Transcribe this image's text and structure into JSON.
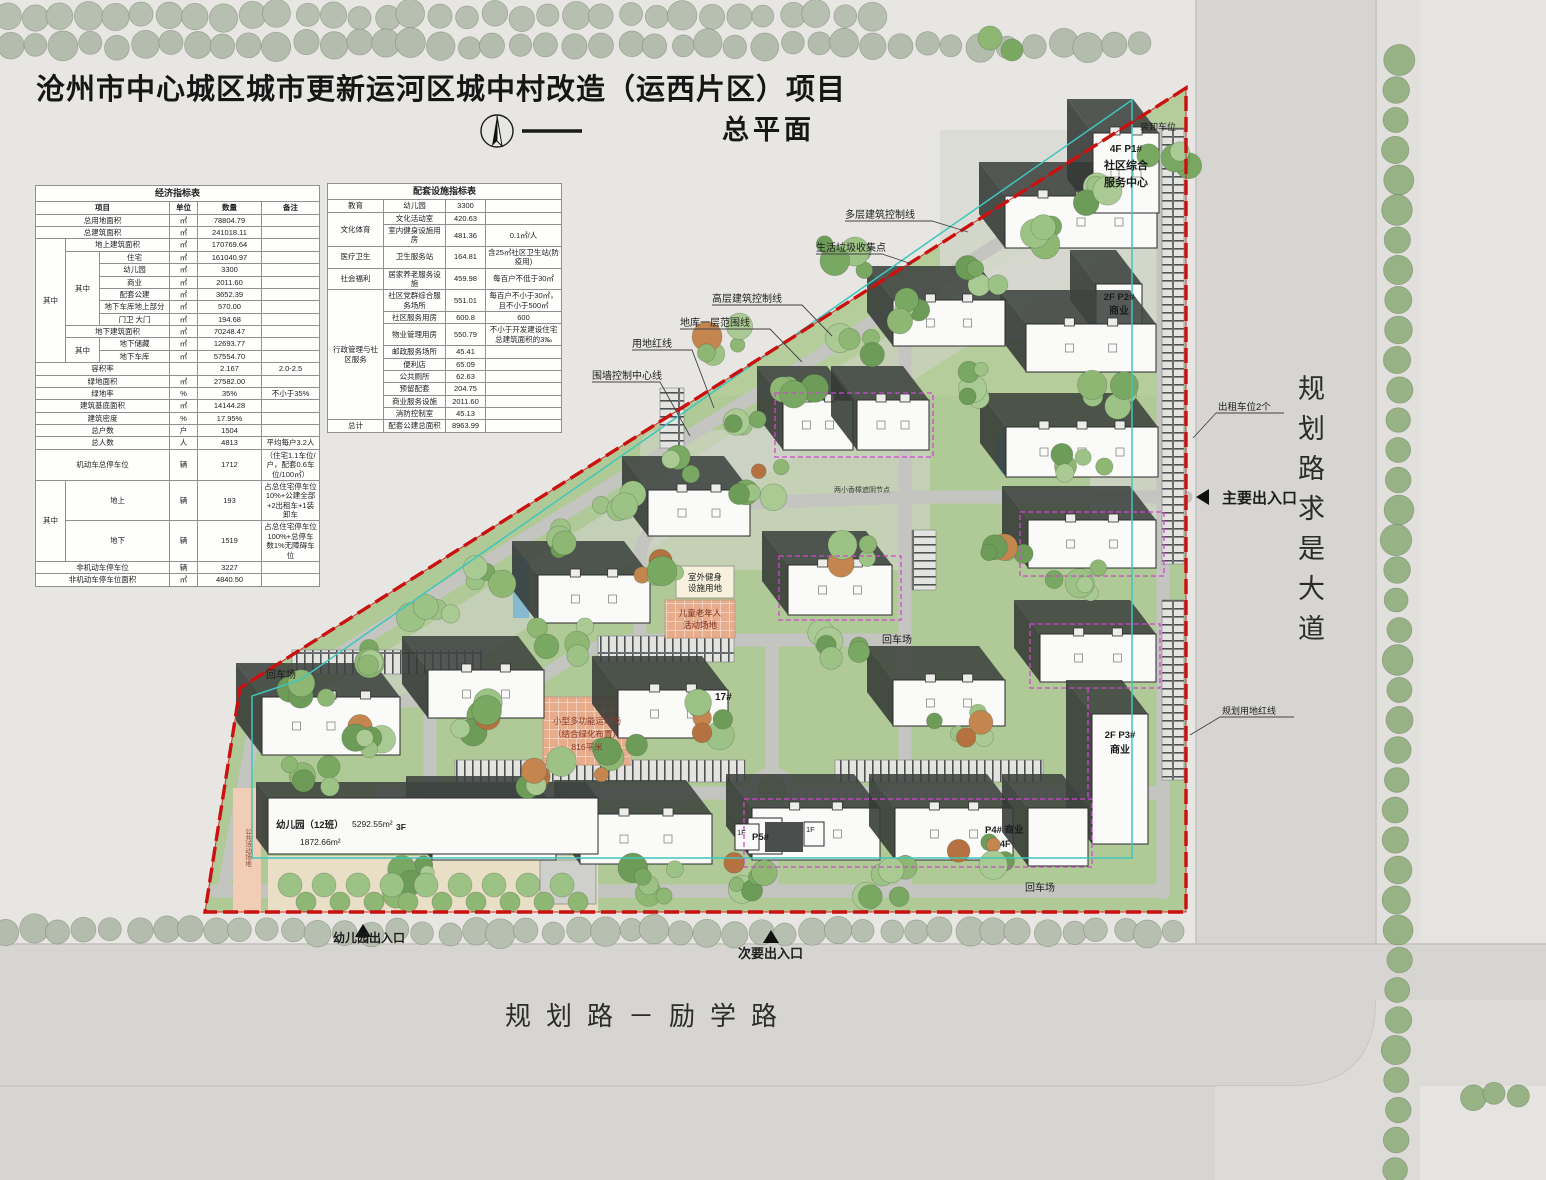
{
  "title": "沧州市中心城区城市更新运河区城中村改造（运西片区）项目",
  "subtitle": "总平面",
  "roads": {
    "east": "规划路求是大道",
    "south": "规划路－励学路"
  },
  "economic_table": {
    "rows": [
      [
        {
          "t": "经济指标表",
          "cs": 6,
          "cl": "th"
        }
      ],
      [
        {
          "t": "项目",
          "cs": 3,
          "cl": "hd"
        },
        {
          "t": "单位",
          "cl": "hd"
        },
        {
          "t": "数量",
          "cl": "hd"
        },
        {
          "t": "备注",
          "cl": "hd"
        }
      ],
      [
        {
          "t": "总用地面积",
          "cs": 3
        },
        {
          "t": "㎡"
        },
        {
          "t": "78804.79"
        },
        {
          "t": ""
        }
      ],
      [
        {
          "t": "总建筑面积",
          "cs": 3
        },
        {
          "t": "㎡"
        },
        {
          "t": "241018.11"
        },
        {
          "t": ""
        }
      ],
      [
        {
          "t": "其中",
          "rs": 10
        },
        {
          "t": "地上建筑面积",
          "cs": 2
        },
        {
          "t": "㎡"
        },
        {
          "t": "170769.64"
        },
        {
          "t": ""
        }
      ],
      [
        {
          "t": "其中",
          "rs": 6
        },
        {
          "t": "住宅"
        },
        {
          "t": "㎡"
        },
        {
          "t": "161040.97"
        },
        {
          "t": ""
        }
      ],
      [
        {
          "t": "幼儿园"
        },
        {
          "t": "㎡"
        },
        {
          "t": "3300"
        },
        {
          "t": ""
        }
      ],
      [
        {
          "t": "商业"
        },
        {
          "t": "㎡"
        },
        {
          "t": "2011.60"
        },
        {
          "t": ""
        }
      ],
      [
        {
          "t": "配套公建"
        },
        {
          "t": "㎡"
        },
        {
          "t": "3652.39"
        },
        {
          "t": ""
        }
      ],
      [
        {
          "t": "地下车库地上部分"
        },
        {
          "t": "㎡"
        },
        {
          "t": "570.00"
        },
        {
          "t": ""
        }
      ],
      [
        {
          "t": "门卫 大门"
        },
        {
          "t": "㎡"
        },
        {
          "t": "194.68"
        },
        {
          "t": ""
        }
      ],
      [
        {
          "t": "地下建筑面积",
          "cs": 2
        },
        {
          "t": "㎡"
        },
        {
          "t": "70248.47"
        },
        {
          "t": ""
        }
      ],
      [
        {
          "t": "其中",
          "rs": 2
        },
        {
          "t": "地下储藏"
        },
        {
          "t": "㎡"
        },
        {
          "t": "12693.77"
        },
        {
          "t": ""
        }
      ],
      [
        {
          "t": "地下车库"
        },
        {
          "t": "㎡"
        },
        {
          "t": "57554.70"
        },
        {
          "t": ""
        }
      ],
      [
        {
          "t": "容积率",
          "cs": 3
        },
        {
          "t": ""
        },
        {
          "t": "2.167"
        },
        {
          "t": "2.0-2.5"
        }
      ],
      [
        {
          "t": "绿地面积",
          "cs": 3
        },
        {
          "t": "㎡"
        },
        {
          "t": "27582.00"
        },
        {
          "t": ""
        }
      ],
      [
        {
          "t": "绿地率",
          "cs": 3
        },
        {
          "t": "%"
        },
        {
          "t": "35%"
        },
        {
          "t": "不小于35%"
        }
      ],
      [
        {
          "t": "建筑基底面积",
          "cs": 3
        },
        {
          "t": "㎡"
        },
        {
          "t": "14144.28"
        },
        {
          "t": ""
        }
      ],
      [
        {
          "t": "建筑密度",
          "cs": 3
        },
        {
          "t": "%"
        },
        {
          "t": "17.95%"
        },
        {
          "t": ""
        }
      ],
      [
        {
          "t": "总户数",
          "cs": 3
        },
        {
          "t": "户"
        },
        {
          "t": "1504"
        },
        {
          "t": ""
        }
      ],
      [
        {
          "t": "总人数",
          "cs": 3
        },
        {
          "t": "人"
        },
        {
          "t": "4813"
        },
        {
          "t": "平均每户3.2人"
        }
      ],
      [
        {
          "t": "机动车总停车位",
          "cs": 3
        },
        {
          "t": "辆"
        },
        {
          "t": "1712"
        },
        {
          "t": "（住宅1.1车位/户，配套0.6车位/100㎡）"
        }
      ],
      [
        {
          "t": "其中",
          "rs": 2
        },
        {
          "t": "地上",
          "cs": 2
        },
        {
          "t": "辆"
        },
        {
          "t": "193"
        },
        {
          "t": "占总住宅停车位10%+公建全部+2出租车+1装卸车"
        }
      ],
      [
        {
          "t": "地下",
          "cs": 2
        },
        {
          "t": "辆"
        },
        {
          "t": "1519"
        },
        {
          "t": "占总住宅停车位100%+总停车数1%无障碍车位"
        }
      ],
      [
        {
          "t": "非机动车停车位",
          "cs": 3
        },
        {
          "t": "辆"
        },
        {
          "t": "3227"
        },
        {
          "t": ""
        }
      ],
      [
        {
          "t": "非机动车停车位面积",
          "cs": 3
        },
        {
          "t": "㎡"
        },
        {
          "t": "4840.50"
        },
        {
          "t": ""
        }
      ]
    ]
  },
  "facilities_table": {
    "rows": [
      [
        {
          "t": "配套设施指标表",
          "cs": 4,
          "cl": "th"
        }
      ],
      [
        {
          "t": "教育"
        },
        {
          "t": "幼儿园"
        },
        {
          "t": "3300"
        },
        {
          "t": ""
        }
      ],
      [
        {
          "t": "文化体育",
          "rs": 2
        },
        {
          "t": "文化活动室"
        },
        {
          "t": "420.63"
        },
        {
          "t": ""
        }
      ],
      [
        {
          "t": "室内健身设施用房"
        },
        {
          "t": "481.36"
        },
        {
          "t": "0.1㎡/人"
        }
      ],
      [
        {
          "t": "医疗卫生"
        },
        {
          "t": "卫生服务站"
        },
        {
          "t": "164.81"
        },
        {
          "t": "含25㎡社区卫生站(防疫用)"
        }
      ],
      [
        {
          "t": "社会福利"
        },
        {
          "t": "居家养老服务设施"
        },
        {
          "t": "459.98"
        },
        {
          "t": "每百户不低于30㎡"
        }
      ],
      [
        {
          "t": "行政管理与社区服务",
          "rs": 9
        },
        {
          "t": "社区党群综合服务场所"
        },
        {
          "t": "551.01"
        },
        {
          "t": "每百户不小于30㎡，且不小于500㎡"
        }
      ],
      [
        {
          "t": "社区服务用房"
        },
        {
          "t": "600.8"
        },
        {
          "t": "600"
        }
      ],
      [
        {
          "t": "物业管理用房"
        },
        {
          "t": "550.79"
        },
        {
          "t": "不小于开发建设住宅总建筑面积的3‰"
        }
      ],
      [
        {
          "t": "邮政服务场所"
        },
        {
          "t": "45.41"
        },
        {
          "t": ""
        }
      ],
      [
        {
          "t": "便利店"
        },
        {
          "t": "65.09"
        },
        {
          "t": ""
        }
      ],
      [
        {
          "t": "公共厕所"
        },
        {
          "t": "62.63"
        },
        {
          "t": ""
        }
      ],
      [
        {
          "t": "预留配套"
        },
        {
          "t": "204.75"
        },
        {
          "t": ""
        }
      ],
      [
        {
          "t": "商业服务设施"
        },
        {
          "t": "2011.60"
        },
        {
          "t": ""
        }
      ],
      [
        {
          "t": "消防控制室"
        },
        {
          "t": "45.13"
        },
        {
          "t": ""
        }
      ],
      [
        {
          "t": "总计"
        },
        {
          "t": "配套公建总面积"
        },
        {
          "t": "8963.99"
        },
        {
          "t": ""
        }
      ]
    ]
  },
  "map": {
    "loading_bays": "装卸车位",
    "taxi_spaces": "出租车位2个",
    "main_entrance": "主要出入口",
    "secondary_entrance": "次要出入口",
    "kindergarten_entrance": "幼儿园出入口",
    "planning_red_line": "规划用地红线",
    "ann_multilayer": "多层建筑控制线",
    "ann_waste": "生活垃圾收集点",
    "ann_highrise": "高层建筑控制线",
    "ann_basement": "地库一层范围线",
    "ann_redline": "用地红线",
    "ann_wall": "围墙控制中心线",
    "turnaround": "回车场",
    "outdoor_fitness_1": "室外健身",
    "outdoor_fitness_2": "设施用地",
    "children_elderly_1": "儿童老年人",
    "children_elderly_2": "活动场地",
    "sports_1": "小型多功能运动场",
    "sports_2": "（结合绿化布置）",
    "sports_3": "816平米",
    "camphor_node": "两小香樟遮阴节点",
    "public_activity": "公共活动场地",
    "b17": "17#",
    "p1_1": "4F  P1#",
    "p1_2": "社区综合",
    "p1_3": "服务中心",
    "p2_1": "2F  P2#",
    "p2_2": "商业",
    "p3_1": "2F  P3#",
    "p3_2": "商业",
    "p4_1": "P4# 商业",
    "p4_2": "4F",
    "p5": "P5#",
    "f1": "1F",
    "kg_name": "幼儿园（12班）",
    "kg_area1": "5292.55m²",
    "kg_area2": "1872.66m²",
    "kg_floors": "3F"
  },
  "colors": {
    "red_line": "#cb1010",
    "cyan_line": "#3fc6bd",
    "magenta_line": "#d245d2",
    "site_green": "#b0ca97",
    "road_gray": "#d6d5d2"
  }
}
